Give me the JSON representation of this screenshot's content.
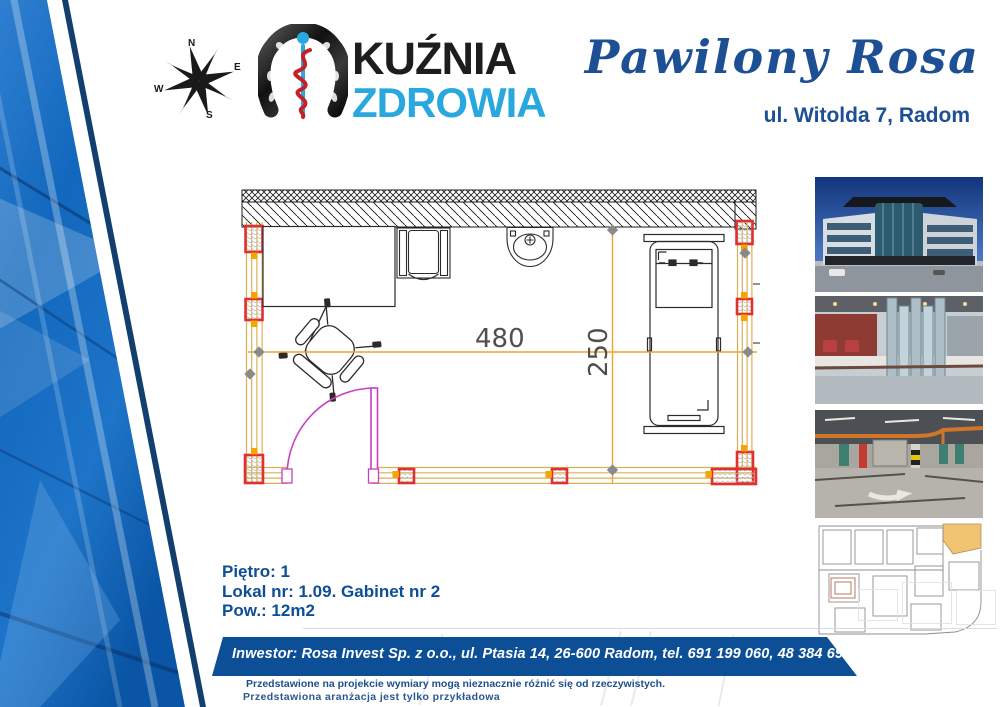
{
  "brand": {
    "line1": "KUŹNIA",
    "line2": "ZDROWIA"
  },
  "header": {
    "project": "Pawilony Rosa",
    "address": "ul. Witolda 7, Radom"
  },
  "compass": {
    "n": "N",
    "e": "E",
    "s": "S",
    "w": "W"
  },
  "plan": {
    "dim_width": "480",
    "dim_height": "250"
  },
  "details": {
    "floor": "Piętro: 1",
    "unit": "Lokal nr: 1.09. Gabinet nr 2",
    "area": "Pow.: 12m2"
  },
  "footer": {
    "investor": "Inwestor: Rosa Invest Sp. z o.o., ul. Ptasia 14, 26-600 Radom, tel. 691 199 060, 48 384 69 09",
    "disclaimer1": "Przedstawione na projekcie wymiary mogą nieznacznie różnić się od rzeczywistych.",
    "disclaimer2": "Przedstawiona aranżacja jest tylko przykładowa"
  },
  "photos": [
    {
      "name": "building-exterior-photo"
    },
    {
      "name": "atrium-interior-photo"
    },
    {
      "name": "underground-parking-photo"
    },
    {
      "name": "building-floor-plan-thumbnail"
    }
  ],
  "icons": {
    "compass": "compass-rose-icon",
    "logo": "horseshoe-asclepius-icon"
  },
  "colors": {
    "brand_dark_blue": "#0d4f96",
    "brand_light_blue": "#29a8e0",
    "logo_black": "#1d1d1b",
    "wall_yellow": "#dcaf54",
    "dimension_orange": "#f0a32e",
    "column_red": "#e0312f",
    "column_orange": "#f5a500",
    "door_magenta": "#c93fc4",
    "left_graphic_blue": "#1268bd"
  }
}
